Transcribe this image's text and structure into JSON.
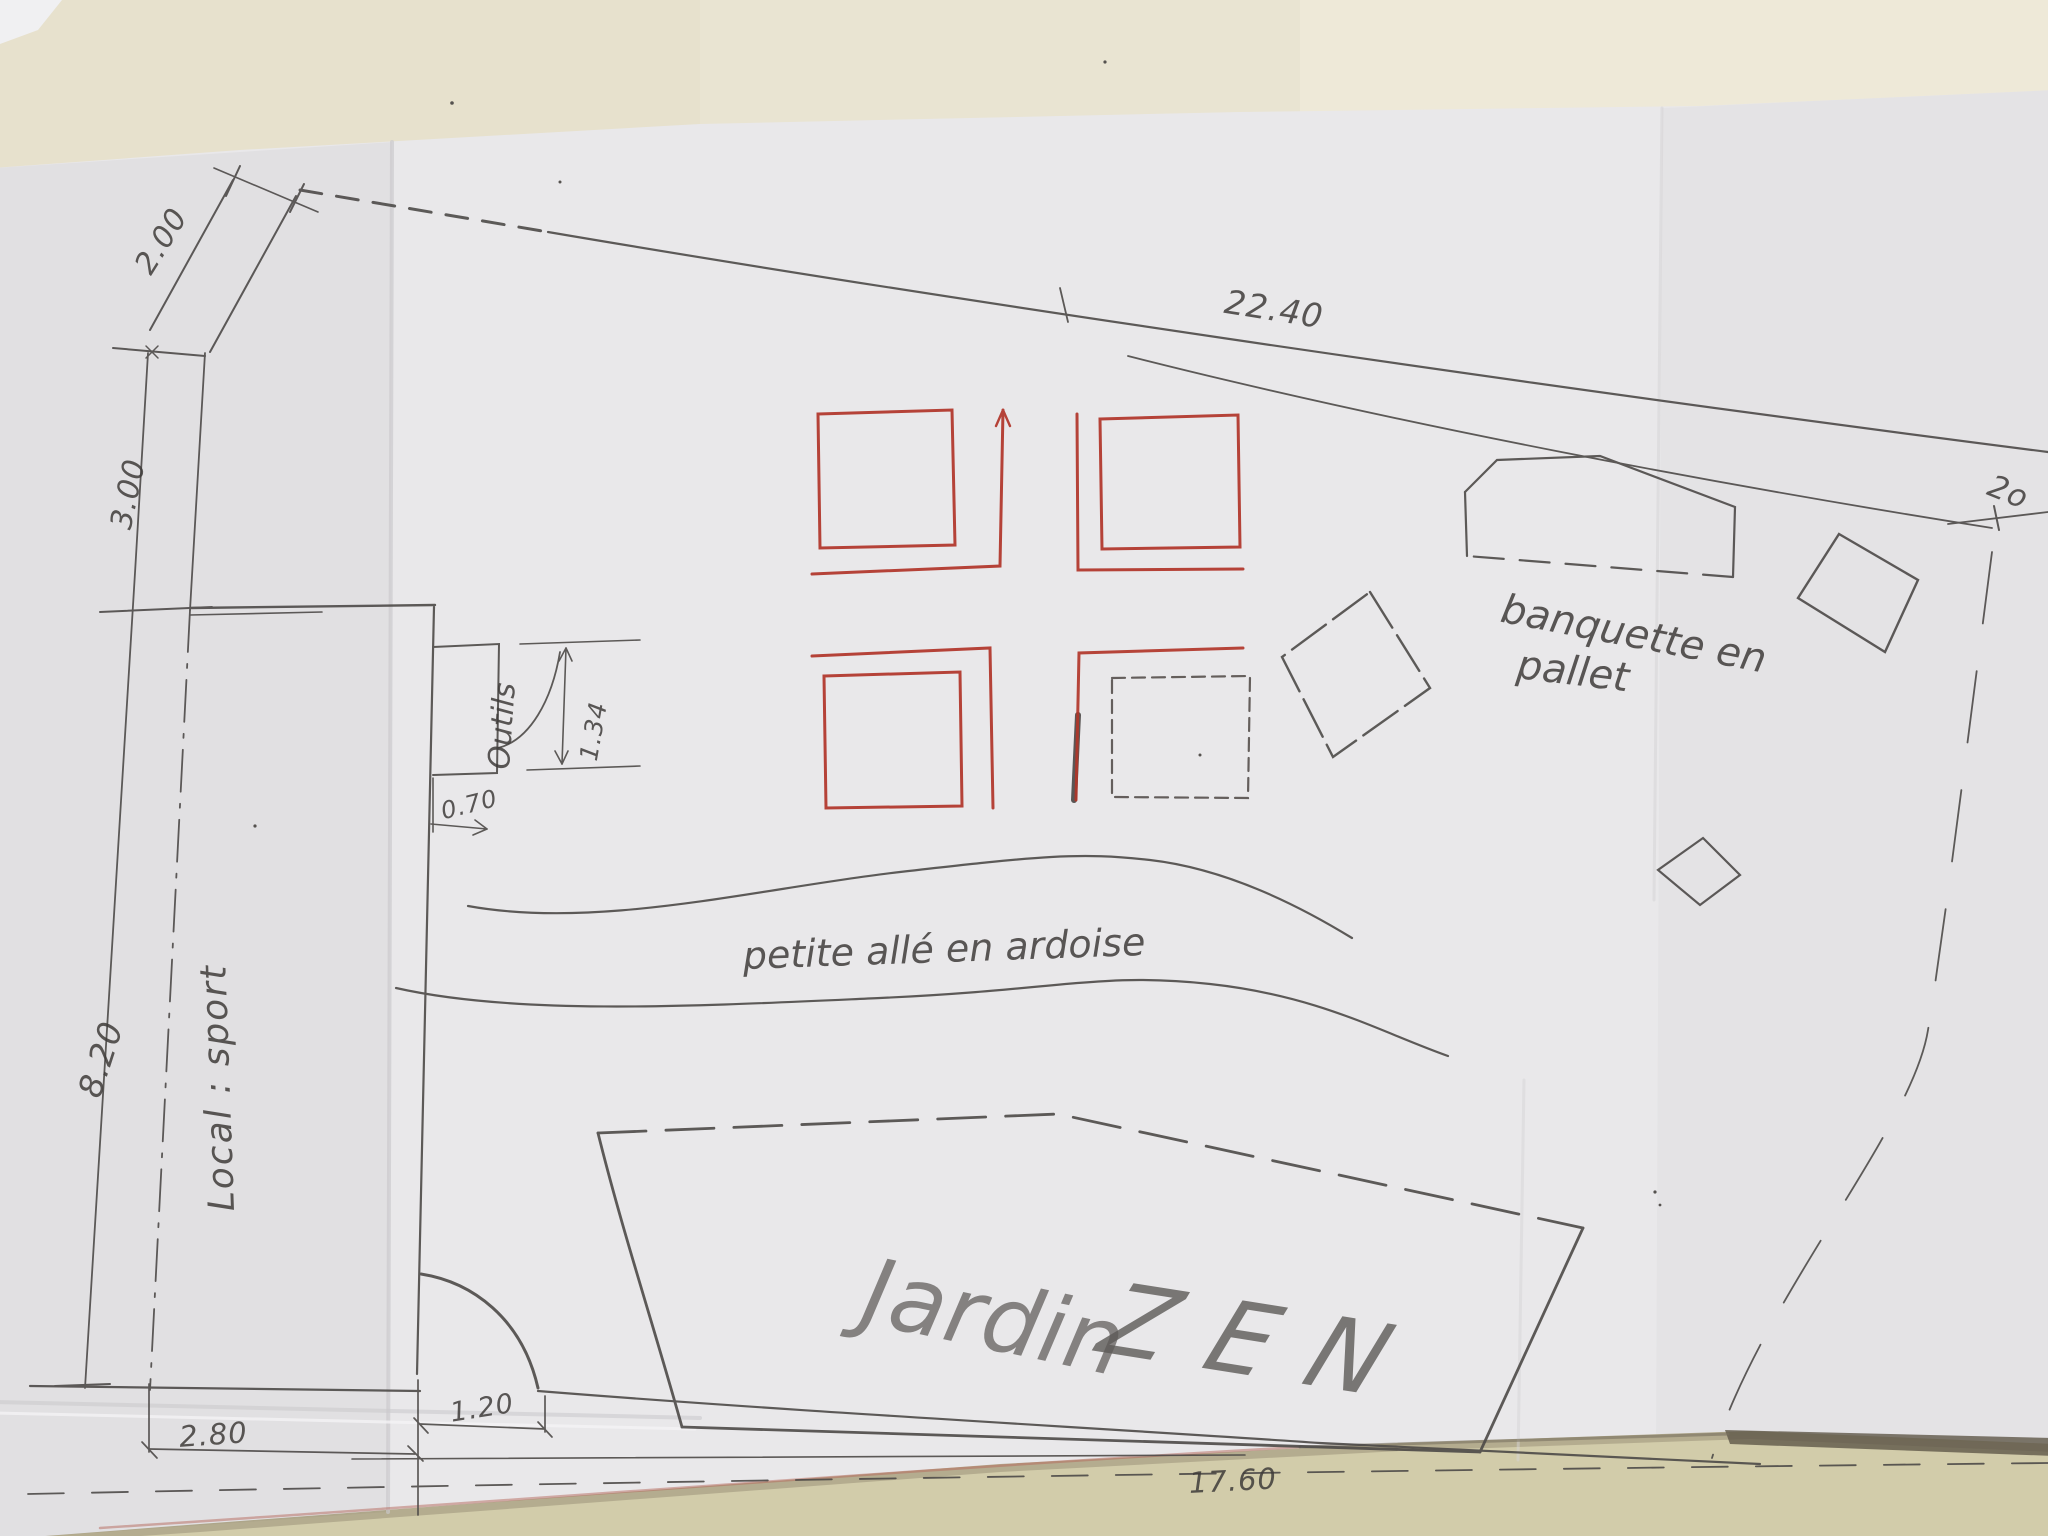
{
  "plan": {
    "title_word1": "Jardin",
    "title_word2": "ZEN",
    "labels": {
      "path": "petite allé en ardoise",
      "bench_line1": "banquette en",
      "bench_line2": "pallet",
      "sport_room": "Local : sport",
      "tool_shed": "Outils"
    },
    "dimensions": {
      "top_left_offset": "2.00",
      "left_upper_height": "3.00",
      "left_lower_height": "8.20",
      "top_boundary_length": "22.40",
      "right_boundary_partial": "2o",
      "shed_door_swing": "1.34",
      "shed_door_width": "0.70",
      "bottom_left_width": "2.80",
      "gate_width": "1.20",
      "bottom_total_length": "17.60"
    },
    "colors": {
      "red_pen": "#b13529",
      "pencil": "#4d4a48",
      "paper": "#e9e8ea",
      "wall_top": "#eae5d3",
      "wall_bottom": "#cfc9a7"
    }
  }
}
